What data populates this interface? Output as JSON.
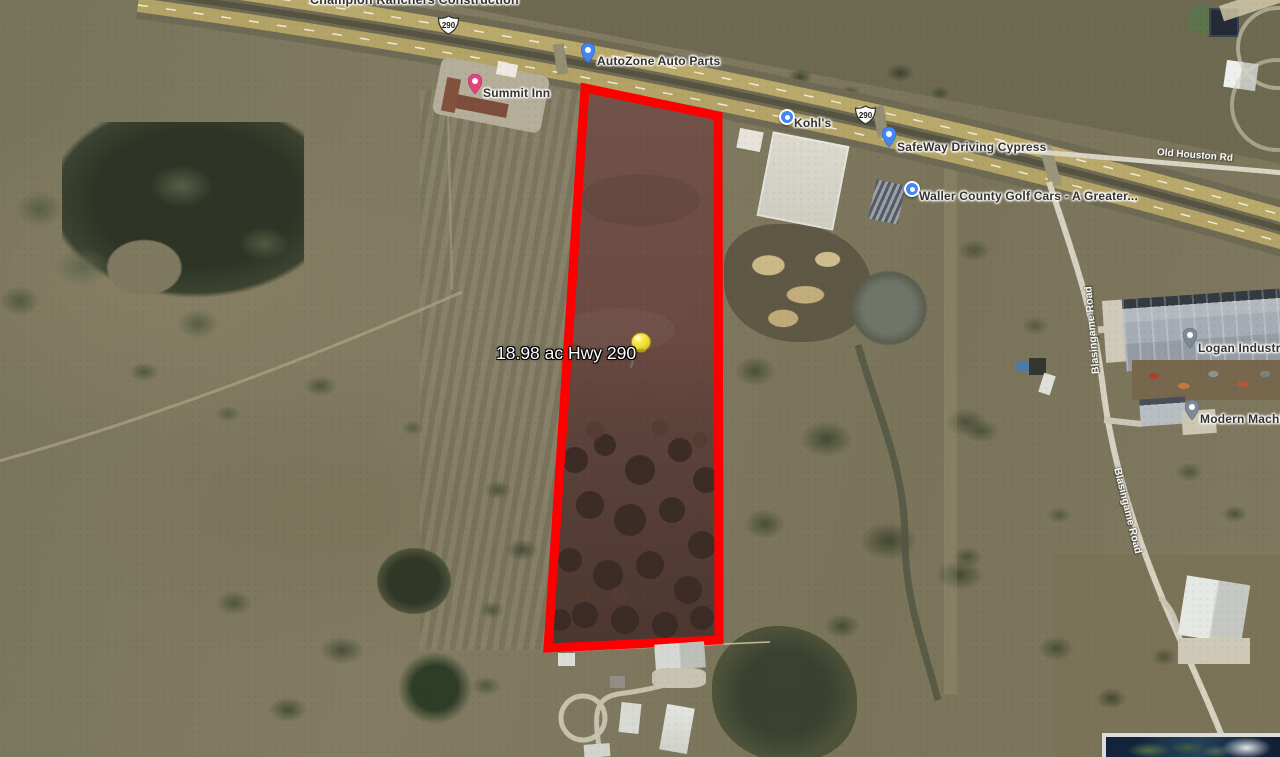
{
  "parcel": {
    "label": "18.98 ac Hwy 290",
    "area_acres": "18.98",
    "outline_color": "#ff0000",
    "marker_icon": "yellow-pushpin"
  },
  "highway": {
    "route": "290"
  },
  "roads": [
    {
      "name": "Old Houston Rd"
    },
    {
      "name": "Blasingame Road"
    },
    {
      "name": "Blasingame Road"
    }
  ],
  "pois": [
    {
      "name": "Champion Ranchers Construction",
      "icon": "label-only"
    },
    {
      "name": "AutoZone Auto Parts",
      "icon": "blue-teardrop-pin"
    },
    {
      "name": "Summit Inn",
      "icon": "pink-lodging-pin"
    },
    {
      "name": "Kohl's",
      "icon": "blue-dot-pin"
    },
    {
      "name": "SafeWay Driving Cypress",
      "icon": "blue-teardrop-pin"
    },
    {
      "name": "Waller County Golf Cars - A Greater...",
      "icon": "blue-dot-pin"
    },
    {
      "name": "Logan Industries",
      "icon": "gray-teardrop-pin"
    },
    {
      "name": "Modern Machine",
      "icon": "gray-teardrop-pin"
    }
  ],
  "overview_inset": {
    "visible": true
  },
  "colors": {
    "parcel_outline": "#ff0000",
    "pin_blue": "#4285f4",
    "pin_pink": "#e0457b",
    "pin_gray": "#7e8b96",
    "pushpin_yellow": "#f2e33c",
    "highway_lane": "#b9a96b"
  }
}
